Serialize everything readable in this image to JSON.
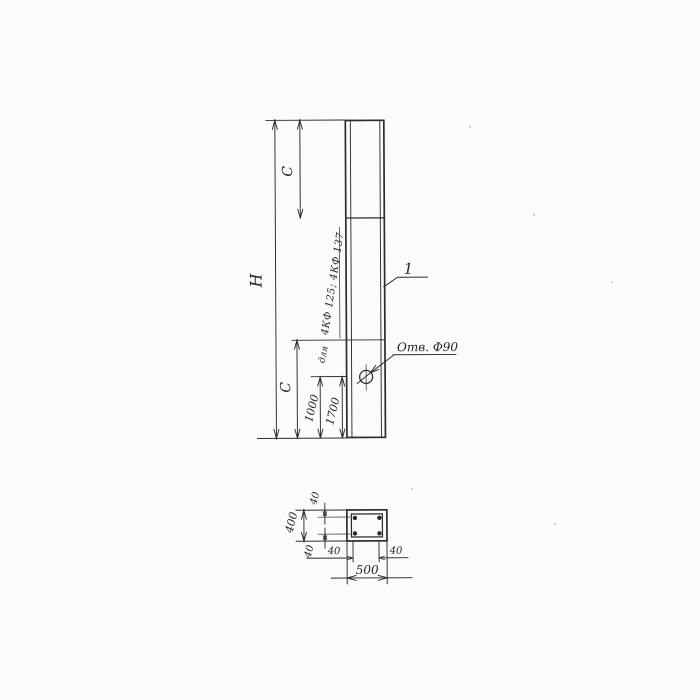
{
  "drawing": {
    "colors": {
      "ink": "#2e2c29",
      "paper": "#fbfbfa"
    },
    "elevation": {
      "height_label": "H",
      "upper_segment_label": "C",
      "lower_segment_label": "C",
      "hole_offset_a": "1000",
      "hole_offset_b": "1700",
      "note_for": "для",
      "note_types": "4КФ 125; 4КФ 137",
      "hole_callout": "Отв. Ф90",
      "position_number": "1"
    },
    "section": {
      "overall_width": "500",
      "overall_height": "400",
      "cover_top": "40",
      "cover_bottom": "40",
      "cover_left": "40",
      "cover_right": "40"
    }
  }
}
